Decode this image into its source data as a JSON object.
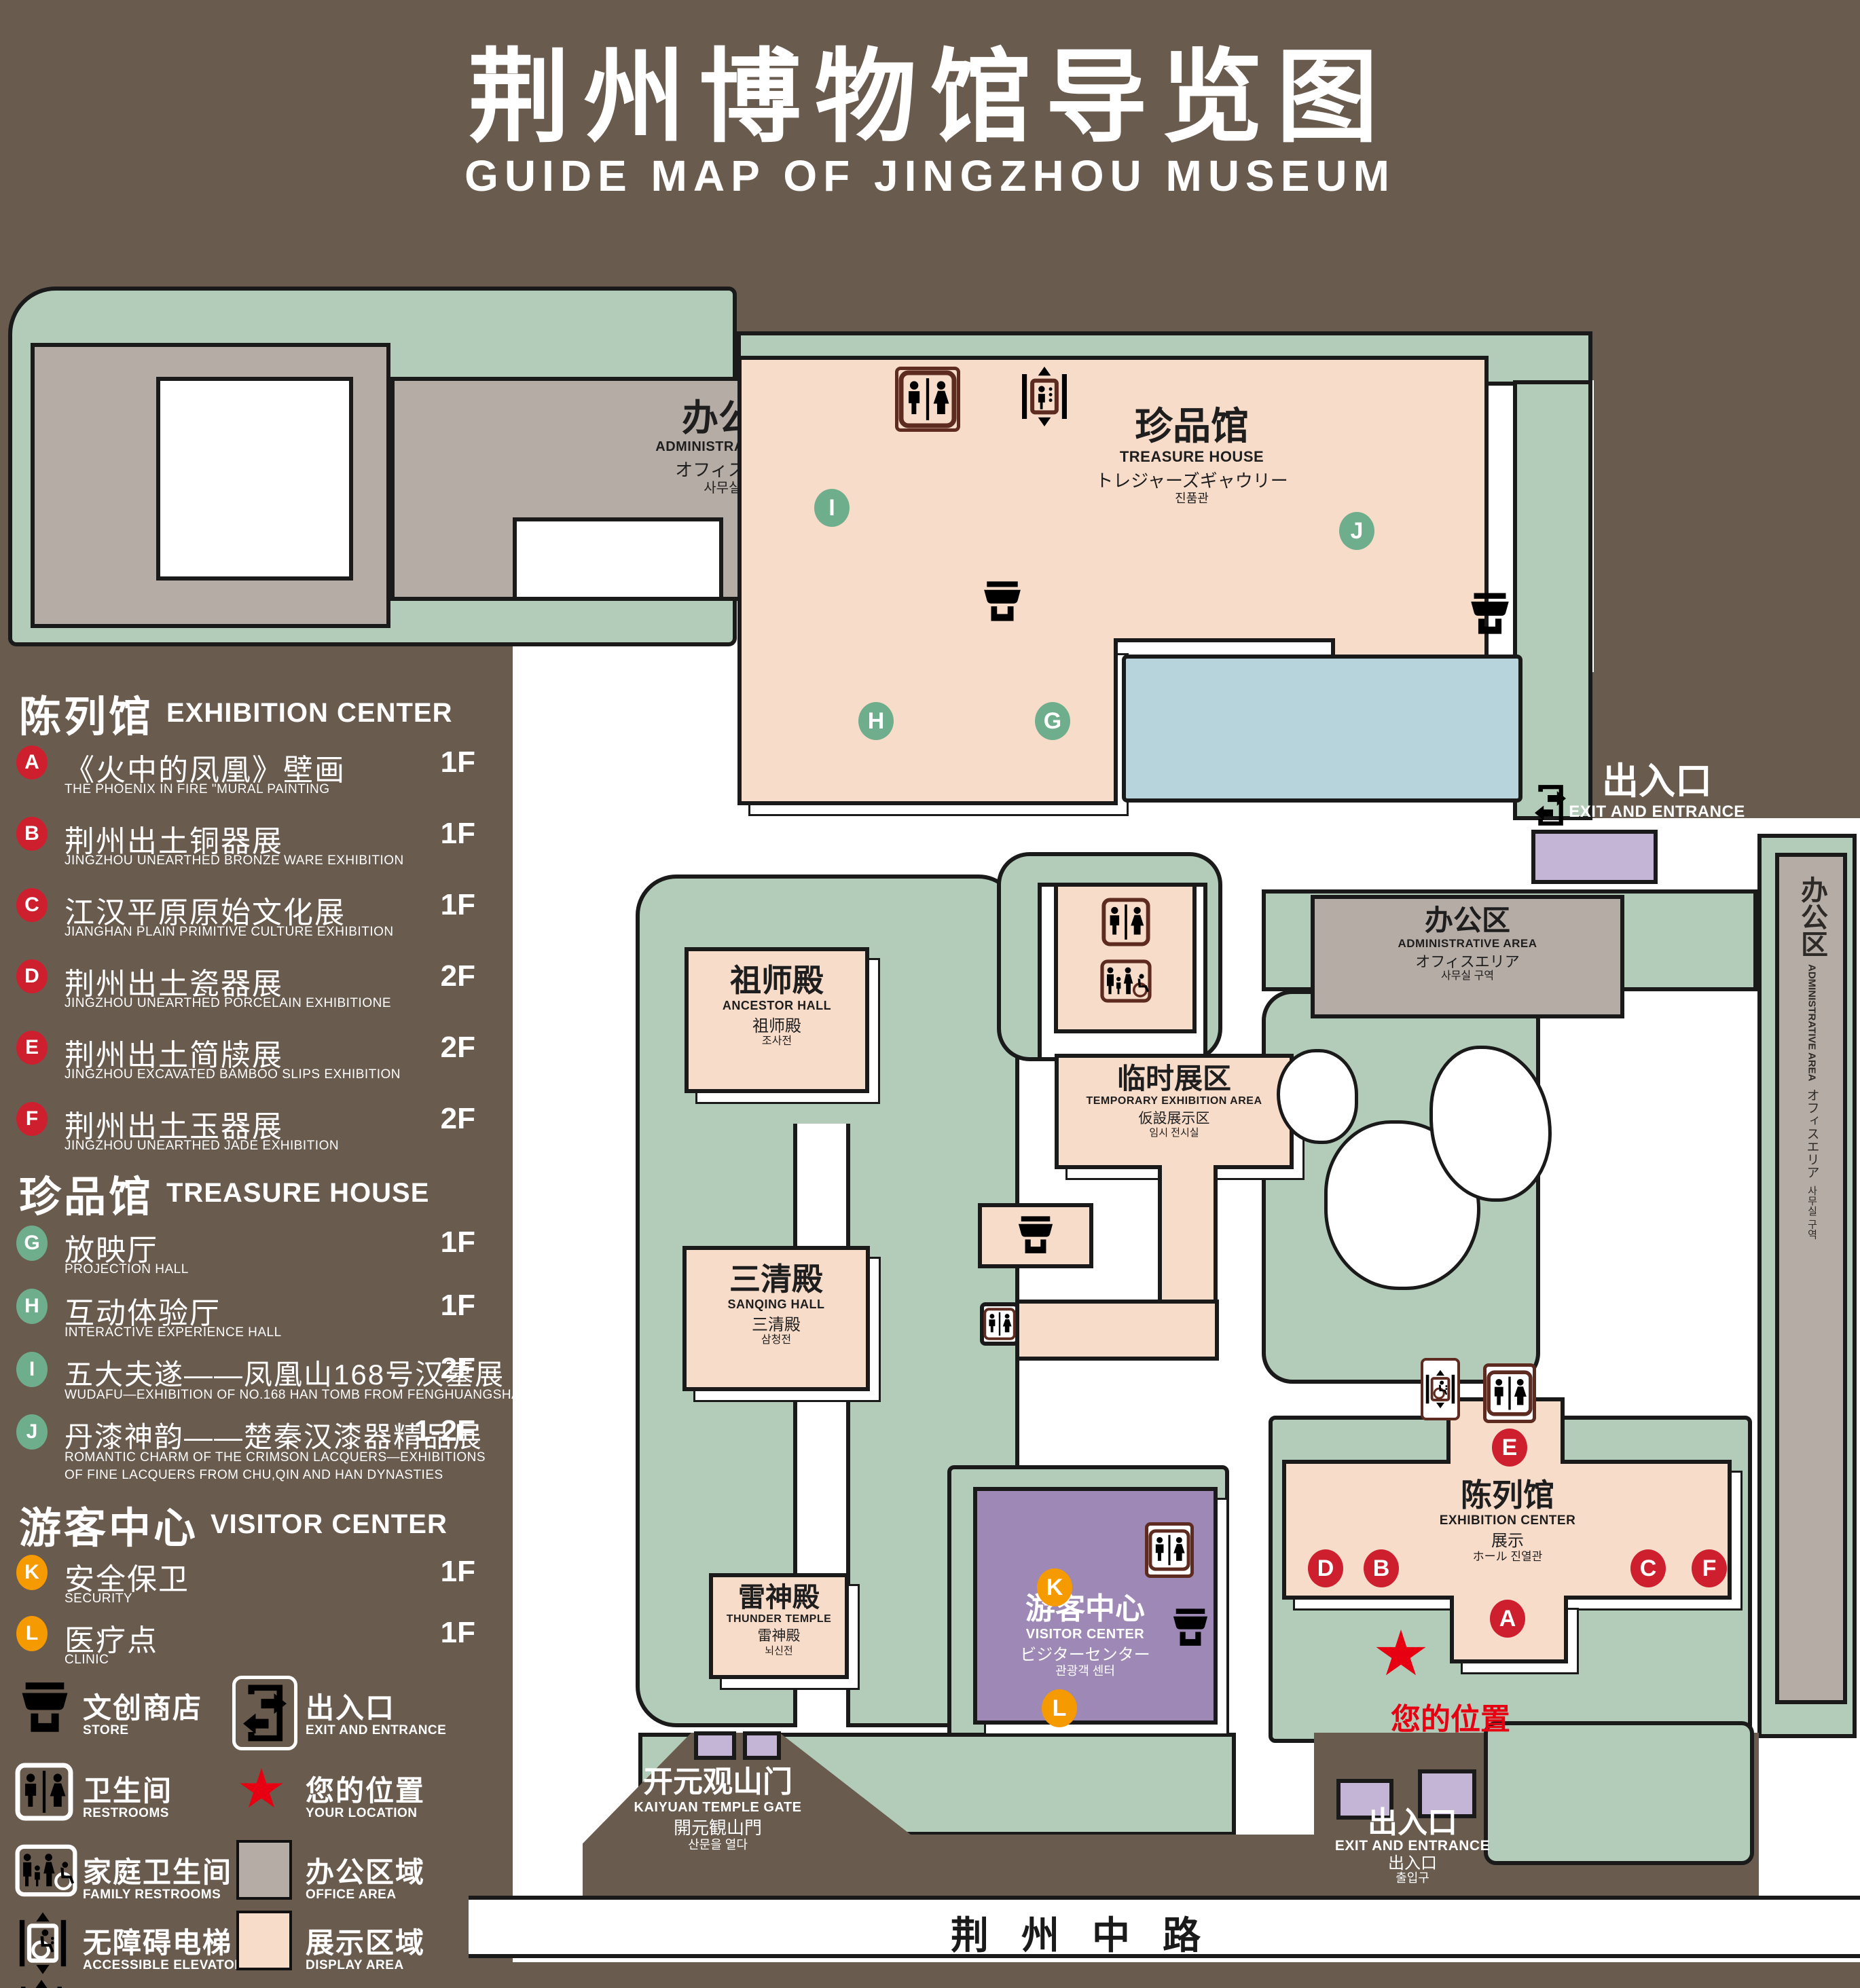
{
  "title": {
    "zh": "荆州博物馆导览图",
    "en": "GUIDE MAP OF JINGZHOU MUSEUM"
  },
  "sidebar": {
    "sections": [
      {
        "title_zh": "陈列馆",
        "title_en": "EXHIBITION CENTER",
        "items": [
          {
            "letter": "A",
            "zh": "《火中的凤凰》壁画",
            "en": "THE PHOENIX IN FIRE \"MURAL PAINTING",
            "floor": "1F"
          },
          {
            "letter": "B",
            "zh": "荆州出土铜器展",
            "en": "JINGZHOU UNEARTHED BRONZE WARE EXHIBITION",
            "floor": "1F"
          },
          {
            "letter": "C",
            "zh": "江汉平原原始文化展",
            "en": "JIANGHAN PLAIN PRIMITIVE CULTURE EXHIBITION",
            "floor": "1F"
          },
          {
            "letter": "D",
            "zh": "荆州出土瓷器展",
            "en": "JINGZHOU UNEARTHED PORCELAIN EXHIBITIONE",
            "floor": "2F"
          },
          {
            "letter": "E",
            "zh": "荆州出土简牍展",
            "en": "JINGZHOU EXCAVATED BAMBOO SLIPS EXHIBITION",
            "floor": "2F"
          },
          {
            "letter": "F",
            "zh": "荆州出土玉器展",
            "en": "JINGZHOU UNEARTHED JADE EXHIBITION",
            "floor": "2F"
          }
        ]
      },
      {
        "title_zh": "珍品馆",
        "title_en": "TREASURE HOUSE",
        "items": [
          {
            "letter": "G",
            "zh": "放映厅",
            "en": "PROJECTION HALL",
            "floor": "1F"
          },
          {
            "letter": "H",
            "zh": "互动体验厅",
            "en": "INTERACTIVE EXPERIENCE HALL",
            "floor": "1F"
          },
          {
            "letter": "I",
            "zh": "五大夫遂——凤凰山168号汉墓展",
            "en": "WUDAFU—EXHIBITION OF NO.168 HAN TOMB FROM FENGHUANGSHAN",
            "floor": "2F"
          },
          {
            "letter": "J",
            "zh": "丹漆神韵——楚秦汉漆器精品展",
            "en": "ROMANTIC CHARM OF THE CRIMSON LACQUERS—EXHIBITIONS",
            "en2": "OF FINE LACQUERS FROM CHU,QIN AND HAN DYNASTIES",
            "floor": "1-2F"
          }
        ]
      },
      {
        "title_zh": "游客中心",
        "title_en": "VISITOR CENTER",
        "items": [
          {
            "letter": "K",
            "zh": "安全保卫",
            "en": "SECURITY",
            "floor": "1F"
          },
          {
            "letter": "L",
            "zh": "医疗点",
            "en": "CLINIC",
            "floor": "1F"
          }
        ]
      }
    ],
    "legend": [
      {
        "icon": "store-icon",
        "zh": "文创商店",
        "en": "STORE"
      },
      {
        "icon": "exit-entrance-icon",
        "zh": "出入口",
        "en": "EXIT AND ENTRANCE"
      },
      {
        "icon": "restroom-icon",
        "zh": "卫生间",
        "en": "RESTROOMS"
      },
      {
        "icon": "location-star-icon",
        "zh": "您的位置",
        "en": "YOUR LOCATION"
      },
      {
        "icon": "family-restroom-icon",
        "zh": "家庭卫生间",
        "en": "FAMILY RESTROOMS"
      },
      {
        "icon": "office-area-swatch",
        "zh": "办公区域",
        "en": "OFFICE AREA"
      },
      {
        "icon": "accessible-elevator-icon",
        "zh": "无障碍电梯",
        "en": "ACCESSIBLE ELEVATOR"
      },
      {
        "icon": "display-area-swatch",
        "zh": "展示区域",
        "en": "DISPLAY AREA"
      },
      {
        "icon": "elevator-icon",
        "zh": "电梯",
        "en": "Elevator"
      }
    ]
  },
  "map": {
    "buildings": {
      "admin_topleft": {
        "zh": "办公区",
        "en": "ADMINISTRATIVE AREA",
        "ja": "オフィスエリア",
        "ko": "사무실 구역"
      },
      "treasure": {
        "zh": "珍品馆",
        "en": "TREASURE HOUSE",
        "ja": "トレジャーズギャウリー",
        "ko": "진품관"
      },
      "ancestor": {
        "zh": "祖师殿",
        "en": "ANCESTOR HALL",
        "ja": "祖师殿",
        "ko": "조사전"
      },
      "temporary": {
        "zh": "临时展区",
        "en": "TEMPORARY EXHIBITION AREA",
        "ja": "仮設展示区",
        "ko": "임시 전시실"
      },
      "sanqing": {
        "zh": "三清殿",
        "en": "SANQING HALL",
        "ja": "三清殿",
        "ko": "삼청전"
      },
      "thunder": {
        "zh": "雷神殿",
        "en": "THUNDER TEMPLE",
        "ja": "雷神殿",
        "ko": "뇌신전"
      },
      "admin_right": {
        "zh": "办公区",
        "en": "ADMINISTRATIVE AREA",
        "ja": "オフィスエリア",
        "ko": "사무실 구역"
      },
      "admin_rightbar": {
        "zh": "办公区",
        "en": "ADMINISTRATIVE AREA",
        "ja": "オフィスエリア",
        "ko": "사무실 구역"
      },
      "exhibition": {
        "zh": "陈列馆",
        "en": "EXHIBITION CENTER",
        "ja": "展示",
        "ko": "ホール 진열관"
      },
      "visitor": {
        "zh": "游客中心",
        "en": "VISITOR CENTER",
        "ja": "ビジターセンター",
        "ko": "관광객 센터"
      },
      "gate": {
        "zh": "开元观山门",
        "en": "KAIYUAN TEMPLE GATE",
        "ja": "開元観山門",
        "ko": "산문을 열다"
      },
      "exit_top": {
        "zh": "出入口",
        "en": "EXIT AND ENTRANCE",
        "ja": "出入口",
        "ko": "출입구"
      },
      "exit_bottom": {
        "zh": "出入口",
        "en": "EXIT AND ENTRANCE",
        "ja": "出入口",
        "ko": "출입구"
      },
      "road": {
        "zh": "荆州中路"
      }
    },
    "your_location": "您的位置",
    "markers": {
      "A": "A",
      "B": "B",
      "C": "C",
      "D": "D",
      "E": "E",
      "F": "F",
      "G": "G",
      "H": "H",
      "I": "I",
      "J": "J",
      "K": "K",
      "L": "L"
    }
  },
  "colors": {
    "background": "#6a5b4f",
    "display_area": "#f8dcca",
    "office_area": "#b5aca6",
    "green_space": "#b3ccba",
    "lake": "#b7d3dc",
    "visitor_center": "#9d88b6",
    "entrance_block": "#c4b4d6",
    "badge_red": "#ce1f2f",
    "badge_green": "#6fae8c",
    "badge_orange": "#f59a00",
    "location_red": "#e60012",
    "icon_brown": "#5d2b20"
  }
}
